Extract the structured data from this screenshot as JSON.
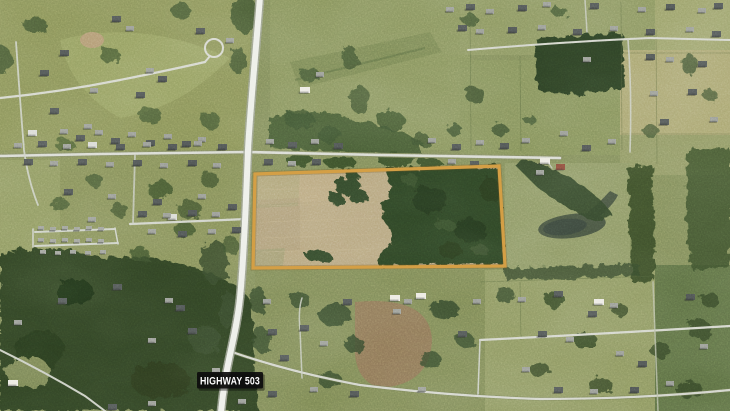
{
  "map": {
    "imagery": "aerial-satellite",
    "highway_label": {
      "text": "HIGHWAY 503",
      "text_color": "#ffffff",
      "background_color": "#0d0d0d"
    },
    "parcel_highlight": {
      "outline_color": "#d49f45"
    }
  }
}
